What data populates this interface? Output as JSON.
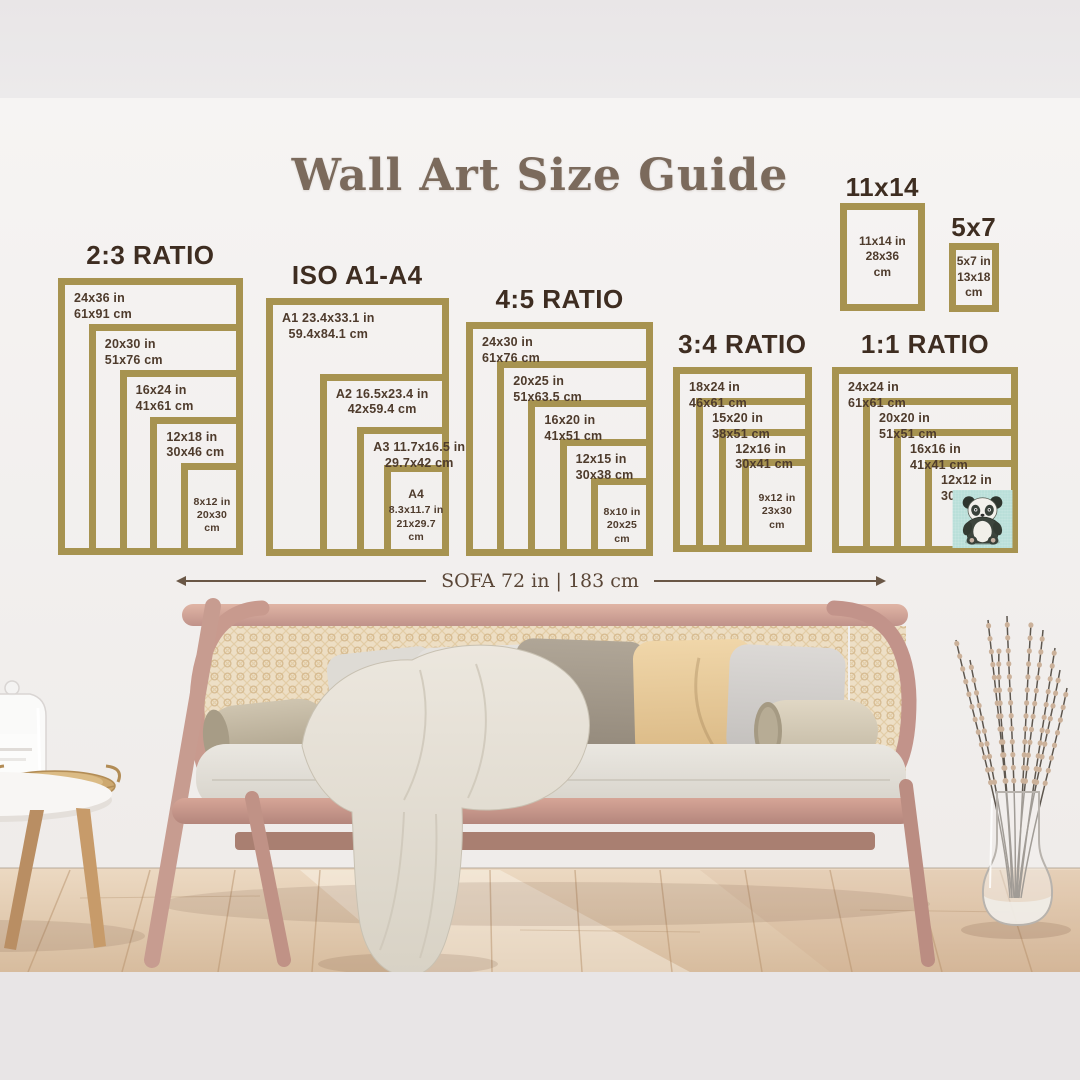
{
  "title": "Wall Art Size Guide",
  "measure": {
    "label": "SOFA 72 in | 183 cm"
  },
  "palette": {
    "frame_gold": "#a79350",
    "heading_brown": "#3e2d21",
    "label_brown": "#4e3b2c",
    "title_brown": "#7b6a5c",
    "measure_brown": "#5a4637",
    "panda_background": "#b9dfd9"
  },
  "groups": [
    {
      "heading": "2:3 RATIO",
      "sizes": [
        {
          "w": 24,
          "h": 36,
          "in": "24x36 in",
          "cm": "61x91 cm"
        },
        {
          "w": 20,
          "h": 30,
          "in": "20x30 in",
          "cm": "51x76 cm"
        },
        {
          "w": 16,
          "h": 24,
          "in": "16x24 in",
          "cm": "41x61 cm"
        },
        {
          "w": 12,
          "h": 18,
          "in": "12x18 in",
          "cm": "30x46 cm"
        },
        {
          "w": 8,
          "h": 12,
          "in": "8x12 in",
          "cm": "20x30 cm",
          "center": true
        }
      ]
    },
    {
      "heading": "ISO A1-A4",
      "center_lines": true,
      "sizes": [
        {
          "w": 23.4,
          "h": 33.1,
          "in": "A1 23.4x33.1 in",
          "cm": "59.4x84.1 cm"
        },
        {
          "w": 16.5,
          "h": 23.4,
          "in": "A2 16.5x23.4 in",
          "cm": "42x59.4 cm"
        },
        {
          "w": 11.7,
          "h": 16.5,
          "in": "A3 11.7x16.5 in",
          "cm": "29.7x42 cm"
        },
        {
          "w": 8.3,
          "h": 11.7,
          "name": "A4",
          "in": "8.3x11.7 in",
          "cm": "21x29.7 cm",
          "center": true
        }
      ]
    },
    {
      "heading": "4:5 RATIO",
      "sizes": [
        {
          "w": 24,
          "h": 30,
          "in": "24x30 in",
          "cm": "61x76 cm"
        },
        {
          "w": 20,
          "h": 25,
          "in": "20x25 in",
          "cm": "51x63.5 cm"
        },
        {
          "w": 16,
          "h": 20,
          "in": "16x20 in",
          "cm": "41x51 cm"
        },
        {
          "w": 12,
          "h": 15,
          "in": "12x15 in",
          "cm": "30x38 cm"
        },
        {
          "w": 8,
          "h": 10,
          "in": "8x10 in",
          "cm": "20x25 cm",
          "center": true
        }
      ]
    },
    {
      "heading": "3:4 RATIO",
      "sizes": [
        {
          "w": 18,
          "h": 24,
          "in": "18x24 in",
          "cm": "46x61 cm"
        },
        {
          "w": 15,
          "h": 20,
          "in": "15x20 in",
          "cm": "38x51 cm"
        },
        {
          "w": 12,
          "h": 16,
          "in": "12x16 in",
          "cm": "30x41 cm"
        },
        {
          "w": 9,
          "h": 12,
          "in": "9x12 in",
          "cm": "23x30 cm",
          "center": true
        }
      ]
    },
    {
      "heading": "1:1 RATIO",
      "has_panda": true,
      "sizes": [
        {
          "w": 24,
          "h": 24,
          "in": "24x24 in",
          "cm": "61x61 cm"
        },
        {
          "w": 20,
          "h": 20,
          "in": "20x20 in",
          "cm": "51x51 cm"
        },
        {
          "w": 16,
          "h": 16,
          "in": "16x16 in",
          "cm": "41x41 cm"
        },
        {
          "w": 12,
          "h": 12,
          "in": "12x12 in",
          "cm": "30x30 cm"
        }
      ]
    }
  ],
  "singles": [
    {
      "heading": "11x14",
      "w": 11,
      "h": 14,
      "in": "11x14 in",
      "cm": "28x36 cm"
    },
    {
      "heading": "5x7",
      "w": 5,
      "h": 7,
      "in": "5x7 in",
      "cm": "13x18 cm"
    }
  ]
}
